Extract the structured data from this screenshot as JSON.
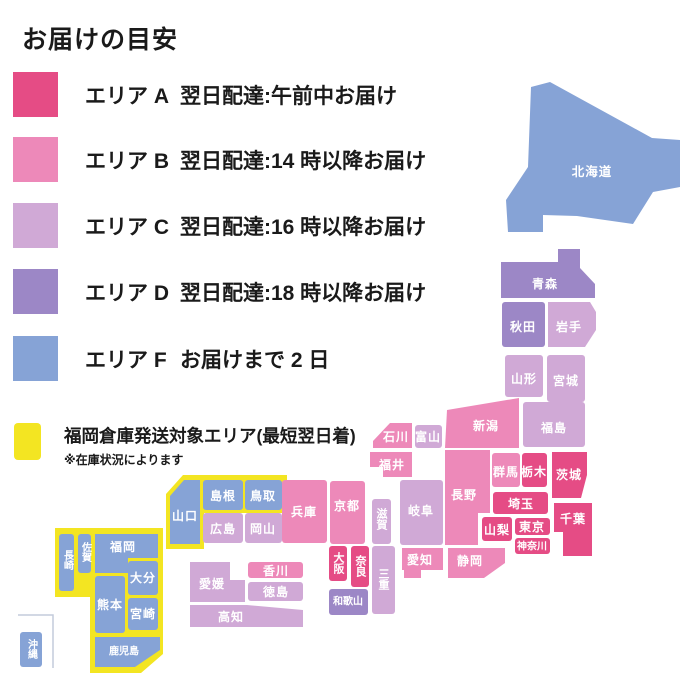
{
  "title": "お届けの目安",
  "legend": {
    "items": [
      {
        "area": "A",
        "area_label": "エリア A",
        "description": "翌日配達:午前中お届け",
        "color": "#e54c85"
      },
      {
        "area": "B",
        "area_label": "エリア B",
        "description": "翌日配達:14 時以降お届け",
        "color": "#ed89b9"
      },
      {
        "area": "C",
        "area_label": "エリア C",
        "description": "翌日配達:16 時以降お届け",
        "color": "#d0a9d6"
      },
      {
        "area": "D",
        "area_label": "エリア D",
        "description": "翌日配達:18 時以降お届け",
        "color": "#9c87c6"
      },
      {
        "area": "F",
        "area_label": "エリア F",
        "description": "お届けまで 2 日",
        "color": "#86a3d6"
      }
    ],
    "fukuoka_notice": {
      "label": "福岡倉庫発送対象エリア(最短翌日着)",
      "note": "※在庫状況によります",
      "color": "#f3e522"
    }
  },
  "colors": {
    "A": "#e54c85",
    "B": "#ed89b9",
    "C": "#d0a9d6",
    "D": "#9c87c6",
    "F": "#86a3d6",
    "highlight": "#f3e522",
    "label_text": "#ffffff"
  },
  "map": {
    "prefectures": {
      "hokkaido": {
        "name": "北海道",
        "area": "F"
      },
      "aomori": {
        "name": "青森",
        "area": "D"
      },
      "akita": {
        "name": "秋田",
        "area": "D"
      },
      "iwate": {
        "name": "岩手",
        "area": "C"
      },
      "yamagata": {
        "name": "山形",
        "area": "C"
      },
      "miyagi": {
        "name": "宮城",
        "area": "C"
      },
      "fukushima": {
        "name": "福島",
        "area": "C"
      },
      "niigata": {
        "name": "新潟",
        "area": "B"
      },
      "gunma": {
        "name": "群馬",
        "area": "B"
      },
      "tochigi": {
        "name": "栃木",
        "area": "A"
      },
      "ibaraki": {
        "name": "茨城",
        "area": "A"
      },
      "saitama": {
        "name": "埼玉",
        "area": "A"
      },
      "chiba": {
        "name": "千葉",
        "area": "A"
      },
      "tokyo": {
        "name": "東京",
        "area": "A"
      },
      "kanagawa": {
        "name": "神奈川",
        "area": "A"
      },
      "yamanashi": {
        "name": "山梨",
        "area": "A"
      },
      "nagano": {
        "name": "長野",
        "area": "B"
      },
      "toyama": {
        "name": "富山",
        "area": "C"
      },
      "ishikawa": {
        "name": "石川",
        "area": "B"
      },
      "fukui": {
        "name": "福井",
        "area": "B"
      },
      "gifu": {
        "name": "岐阜",
        "area": "C"
      },
      "shizuoka": {
        "name": "静岡",
        "area": "B"
      },
      "aichi": {
        "name": "愛知",
        "area": "B"
      },
      "shiga": {
        "name": "滋賀",
        "area": "C"
      },
      "kyoto": {
        "name": "京都",
        "area": "B"
      },
      "osaka": {
        "name": "大阪",
        "area": "A"
      },
      "hyogo": {
        "name": "兵庫",
        "area": "B"
      },
      "nara": {
        "name": "奈良",
        "area": "A"
      },
      "wakayama": {
        "name": "和歌山",
        "area": "D"
      },
      "mie": {
        "name": "三重",
        "area": "C"
      },
      "tottori": {
        "name": "鳥取",
        "area": "F",
        "fukuoka_warehouse": true
      },
      "shimane": {
        "name": "島根",
        "area": "F",
        "fukuoka_warehouse": true
      },
      "okayama": {
        "name": "岡山",
        "area": "C"
      },
      "hiroshima": {
        "name": "広島",
        "area": "C"
      },
      "yamaguchi": {
        "name": "山口",
        "area": "F",
        "fukuoka_warehouse": true
      },
      "tokushima": {
        "name": "徳島",
        "area": "C"
      },
      "kagawa": {
        "name": "香川",
        "area": "B"
      },
      "ehime": {
        "name": "愛媛",
        "area": "C"
      },
      "kochi": {
        "name": "高知",
        "area": "C"
      },
      "fukuoka": {
        "name": "福岡",
        "area": "F",
        "fukuoka_warehouse": true
      },
      "saga": {
        "name": "佐賀",
        "area": "F",
        "fukuoka_warehouse": true
      },
      "nagasaki": {
        "name": "長崎",
        "area": "F",
        "fukuoka_warehouse": true
      },
      "kumamoto": {
        "name": "熊本",
        "area": "F",
        "fukuoka_warehouse": true
      },
      "oita": {
        "name": "大分",
        "area": "F",
        "fukuoka_warehouse": true
      },
      "miyazaki": {
        "name": "宮崎",
        "area": "F",
        "fukuoka_warehouse": true
      },
      "kagoshima": {
        "name": "鹿児島",
        "area": "F",
        "fukuoka_warehouse": true
      },
      "okinawa": {
        "name": "沖縄",
        "area": "F"
      }
    }
  }
}
